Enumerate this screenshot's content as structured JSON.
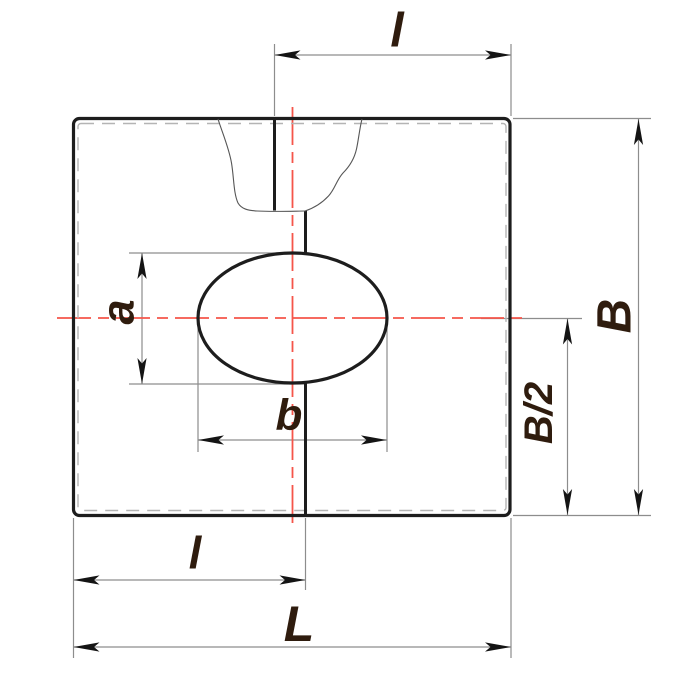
{
  "drawing": {
    "labels": {
      "l_top": "l",
      "B": "B",
      "B_half": "B/2",
      "a": "a",
      "b": "b",
      "l_bottom": "l",
      "L": "L"
    },
    "colors": {
      "background": "#ffffff",
      "outline_black": "#1d1d1d",
      "centerline_red": "#f5554a",
      "dimension_gray": "#8d8d8d",
      "hidden_edge_gray": "#b4b4b4",
      "label_dark_brown": "#2f1c0e"
    }
  }
}
